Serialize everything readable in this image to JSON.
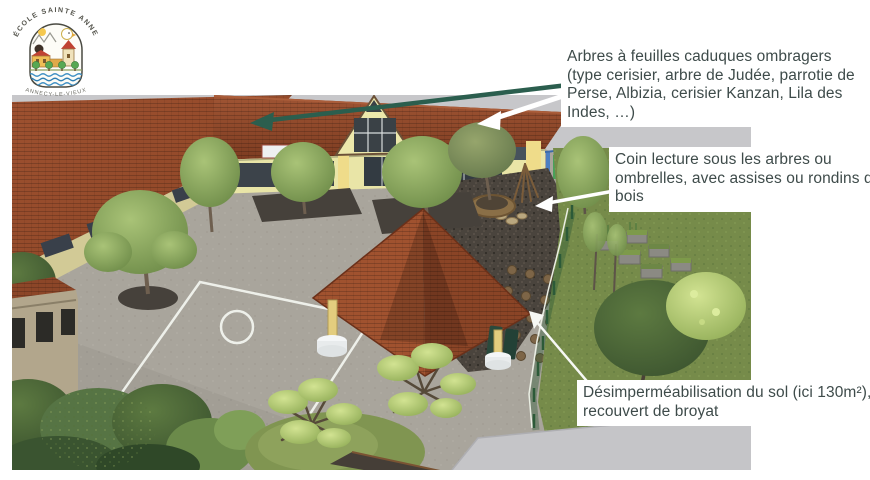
{
  "logo": {
    "arc_top": "ÉCOLE SAINTE ANNE",
    "arc_bottom": "ANNECY-LE-VIEUX"
  },
  "annotations": {
    "trees": {
      "text": "Arbres à feuilles caduques ombragers (type cerisier, arbre de Judée, parrotie de Perse, Albizia, cerisier Kanzan, Lila des Indes, …)"
    },
    "reading": {
      "text": "Coin lecture sous les arbres ou ombrelles, avec assises ou rondins de bois"
    },
    "soil": {
      "text": "Désimperméabilisation du sol (ici 130m²), recouvert de broyat"
    }
  },
  "colors": {
    "annotation_text": "#3e4b4a",
    "callout_arrow_green": "#2b5e4e",
    "callout_arrow_white": "#ffffff",
    "annotation_box_background": "#ffffff",
    "roof_red": "#93482a",
    "wall_yellow": "#e9e5a7",
    "grass_green": "#768b4a",
    "pavement_gray": "#a9a59c",
    "sky_gray": "#c7c7ca",
    "mulch_dark": "#4a443d"
  }
}
